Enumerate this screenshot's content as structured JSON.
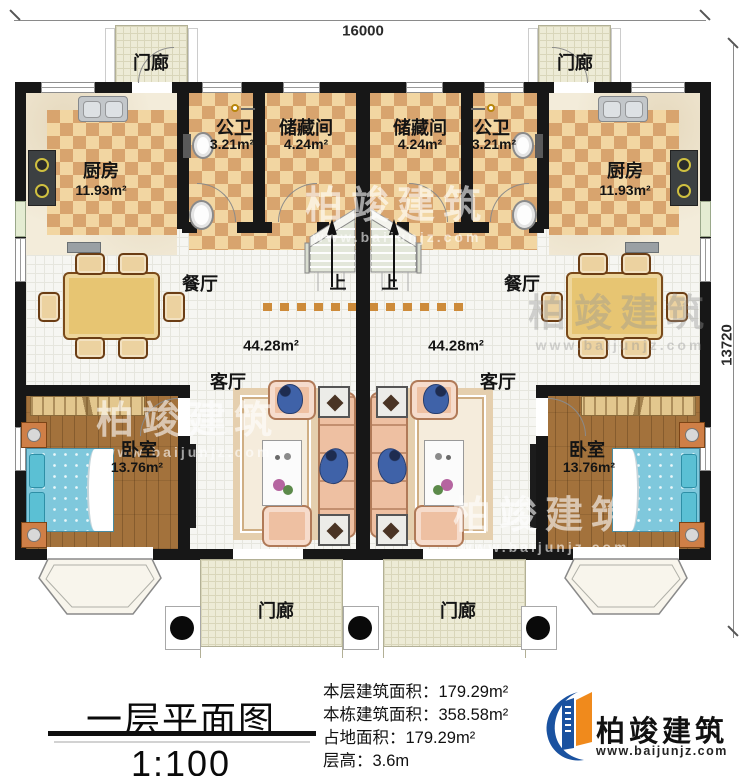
{
  "plan": {
    "dim_width": "16000",
    "dim_depth": "13720"
  },
  "rooms": {
    "porch": "门廊",
    "kitchen": "厨房",
    "kitchen_area": "11.93m²",
    "bath": "公卫",
    "bath_area": "3.21m²",
    "storage": "储藏间",
    "storage_area": "4.24m²",
    "dining": "餐厅",
    "living": "客厅",
    "hall_area": "44.28m²",
    "bedroom": "卧室",
    "bedroom_area": "13.76m²",
    "stairs_up": "上"
  },
  "footer": {
    "title": "一层平面图",
    "scale": "1:100",
    "stats": [
      {
        "label": "本层建筑面积：",
        "value": "179.29m²"
      },
      {
        "label": "本栋建筑面积：",
        "value": "358.58m²"
      },
      {
        "label": "占地面积：",
        "value": "179.29m²"
      },
      {
        "label": "层高：",
        "value": "3.6m"
      }
    ]
  },
  "brand": {
    "name": "柏竣建筑",
    "site": "www.baijunjz.com"
  },
  "watermark": {
    "name": "柏竣建筑",
    "site": "www.baijunjz.com"
  },
  "colors": {
    "wall": "#171717",
    "checker_light": "#f2d6a2",
    "checker_dark": "#d8a46e",
    "brand_blue": "#1a52a0",
    "brand_orange": "#f08a1c"
  }
}
